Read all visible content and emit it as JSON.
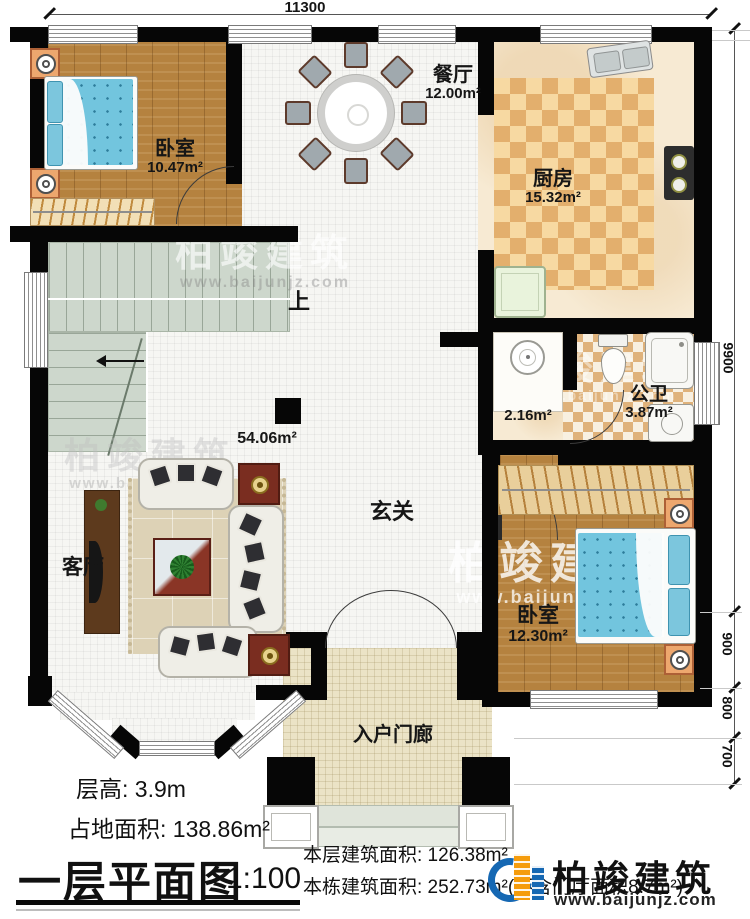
{
  "brand": {
    "name": "柏竣建筑",
    "website": "www.baijunjz.com"
  },
  "dimensions": {
    "top_width": "11300",
    "right_total": "9900",
    "right_segments": [
      "900",
      "800",
      "700"
    ]
  },
  "rooms": {
    "bedroom1": {
      "name": "卧室",
      "area": "10.47m²"
    },
    "dining": {
      "name": "餐厅",
      "area": "12.00m²"
    },
    "kitchen": {
      "name": "厨房",
      "area": "15.32m²"
    },
    "bathroom": {
      "name": "公卫",
      "area": "3.87m²"
    },
    "washnook": {
      "area": "2.16m²"
    },
    "hall": {
      "name": "玄关",
      "area": "54.06m²"
    },
    "living": {
      "name": "客厅"
    },
    "bedroom2": {
      "name": "卧室",
      "area": "12.30m²"
    },
    "porch": {
      "name": "入户门廊"
    }
  },
  "stairs": {
    "up_label": "上"
  },
  "title_block": {
    "floor_height": "层高: 3.9m",
    "land_area": "占地面积: 138.86m²",
    "plan_title": "一层平面图",
    "scale": "1:100",
    "floor_area": "本层建筑面积: 126.38m²",
    "building_area": "本栋建筑面积: 252.73m²(不含门厅面积8.7m²)"
  }
}
